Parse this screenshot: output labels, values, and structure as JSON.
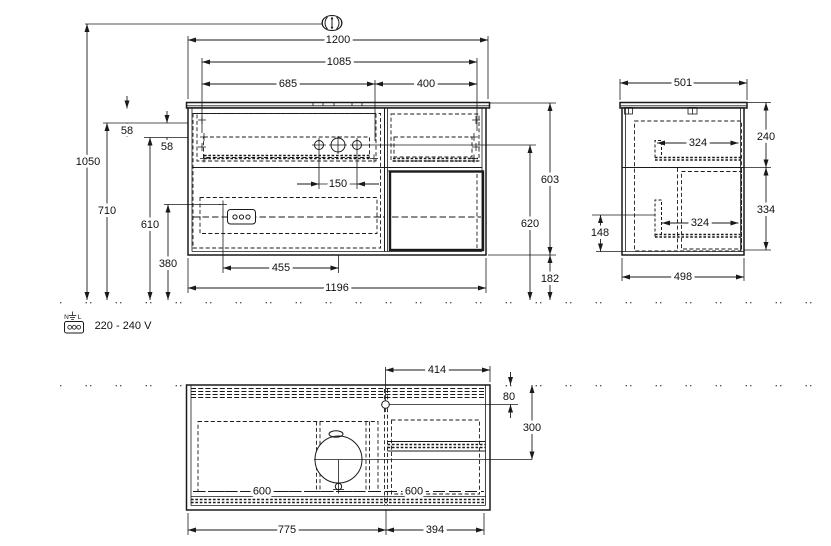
{
  "drawing": {
    "type": "technical-installation-drawing",
    "views": {
      "front": "front-elevation",
      "side": "side-section",
      "bottom": "plan-from-below"
    }
  },
  "dimensions": {
    "front": {
      "w1200": "1200",
      "w1085": "1085",
      "w685": "685",
      "w400": "400",
      "h1050": "1050",
      "h710": "710",
      "h610": "610",
      "h380": "380",
      "off58_top": "58",
      "off58_mid": "58",
      "tap150": "150",
      "outlet455": "455",
      "body1196": "1196",
      "h603": "603",
      "h620": "620",
      "gap182": "182"
    },
    "side": {
      "d501": "501",
      "h240": "240",
      "rail324_top": "324",
      "rail324_bottom": "324",
      "h334": "334",
      "h148": "148",
      "d498": "498"
    },
    "plan": {
      "w414": "414",
      "off80": "80",
      "d300": "300",
      "rail600_left": "600",
      "rail600_right": "600",
      "w775": "775",
      "w394": "394"
    }
  },
  "electrical": {
    "voltage": "220 - 240 V",
    "terminal_n": "N",
    "terminal_l": "L"
  },
  "icons": {
    "height_adjustable": "oval with vertical double arrow",
    "power_socket": "box with three terminals",
    "ground": "earth symbol"
  },
  "colors": {
    "line": "#1a1a1a",
    "background": "#ffffff"
  }
}
